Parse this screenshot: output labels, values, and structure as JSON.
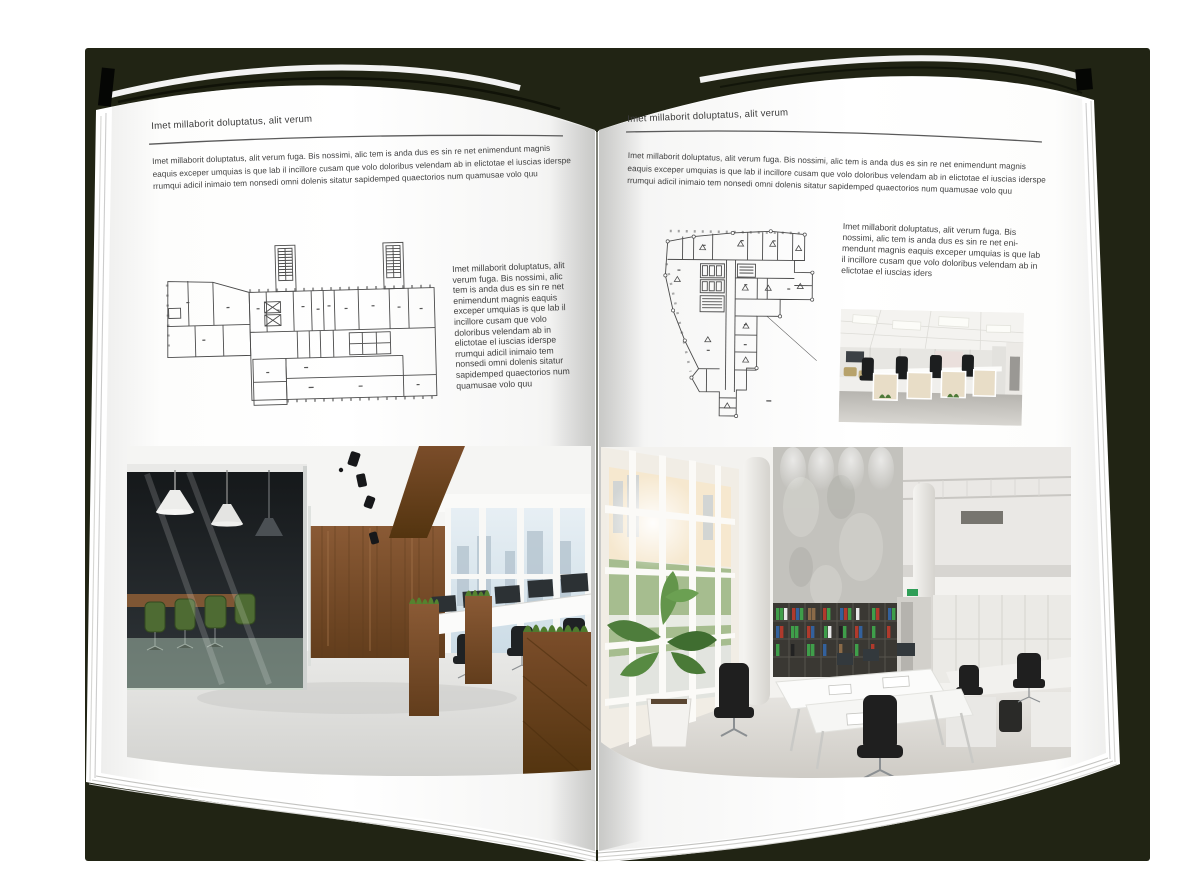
{
  "book": {
    "left_page": {
      "header": "Imet millaborit doluptatus, alit verum",
      "intro": "Imet millaborit doluptatus, alit verum fuga. Bis nossimi, alic tem is anda dus es sin re net enimendunt magnis eaquis exceper umquias is que lab il incillore cusam que volo doloribus velendam ab in elictotae el iuscias iderspe rrumqui adicil inimaio tem nonsedi omni dolenis sitatur sapidemped quaectorios num quamusae volo quu",
      "side_text": "Imet millaborit doluptatus, alit verum fuga. Bis nossimi, alic tem is anda dus es sin re net enimendunt magnis eaquis exceper umquias is que lab il incillore cusam que volo doloribus velendam ab in elictotae el iuscias iderspe rrumqui adicil inimaio tem nonsedi omni dolenis sitatur sapidemped quaectorios num quamusae volo quu"
    },
    "right_page": {
      "header": "Imet millaborit doluptatus, alit verum",
      "intro": "Imet millaborit doluptatus, alit verum fuga. Bis nossimi, alic tem is anda dus es sin re net enimendunt magnis eaquis exceper umquias is que lab il incillore cusam que volo doloribus velendam ab in elictotae el iuscias iderspe rrumqui adicil inimaio tem nonsedi omni dolenis sitatur sapidemped quaectorios num quamusae volo quu",
      "side_text": "Imet millaborit doluptatus, alit verum fuga. Bis nossimi, alic tem is anda dus es sin re net eni-mendunt magnis eaquis exceper umquias is que lab il incillore cusam que volo doloribus velendam ab in elictotae el iuscias iders"
    }
  },
  "images": {
    "left_floorplan": "architectural-floor-plan",
    "right_floorplan": "architectural-floor-plan",
    "left_photo": "loft-office-interior-photo",
    "right_photo": "bright-open-office-interior-photo",
    "small_photo": "office-workstations-photo"
  },
  "colors": {
    "backdrop": "#212414",
    "page": "#ffffff",
    "text": "#3f3f3f",
    "rule": "#5a5a5a",
    "plan_line": "#4b4b4b",
    "wood": "#7b5233",
    "chair_green": "#4e6b33",
    "binder_green": "#3f9e4a",
    "binder_red": "#b03a2c",
    "binder_blue": "#33619c"
  }
}
